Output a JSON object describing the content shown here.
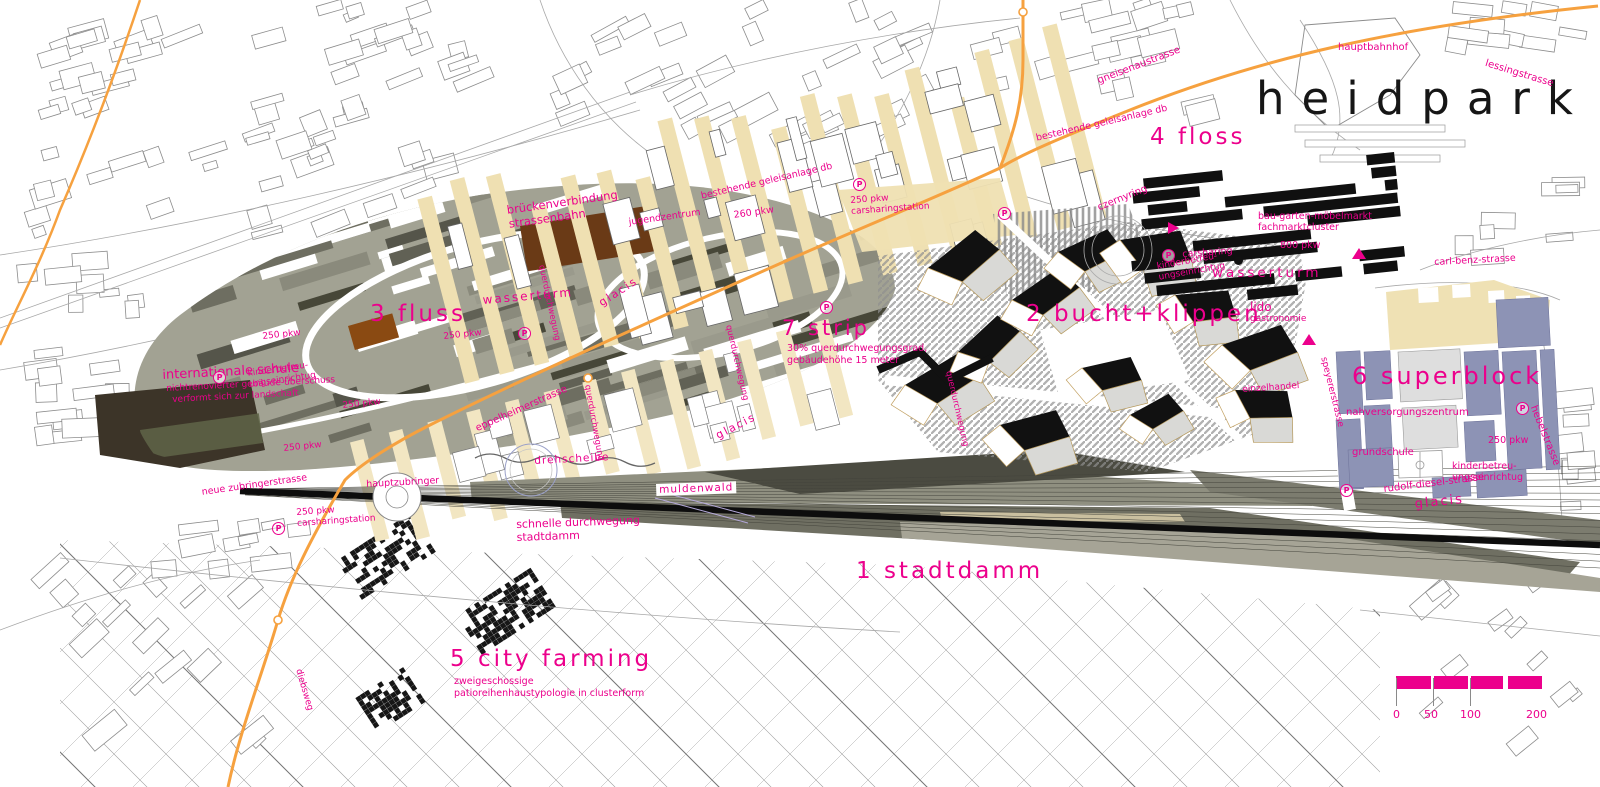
{
  "title": "heidpark",
  "zones": {
    "stadtdamm": {
      "label": "1 stadtdamm"
    },
    "bucht": {
      "label": "2 bucht+klippen"
    },
    "fluss": {
      "label": "3 fluss"
    },
    "floss": {
      "label": "4 floss"
    },
    "cityfarming": {
      "label": "5 city farming",
      "sub1": "zweigeschossige",
      "sub2": "patioreihenhaustypologie in clusterform"
    },
    "superblock": {
      "label": "6 superblock"
    },
    "strip": {
      "label": "7 strip",
      "sub1": "30% querdurchwegungsgrad,",
      "sub2": "gebäudehöhe 15 meter"
    }
  },
  "streets": {
    "gneisenaustrasse": "gneisenaustrasse",
    "lessingstrasse": "lessingstrasse",
    "carlbenz": "carl-benz-strasse",
    "czernyring": "czernyring",
    "eppelheimerstrasse": "eppelheimerstrasse",
    "speyererstrasse": "speyererstrasse",
    "hebelstrasse": "hebelstrasse",
    "rudolfdiesel": "rudolf-diesel-strasse",
    "neuezubringer": "neue zubringerstrasse",
    "hauptzubringer": "hauptzubringer",
    "diebsweg": "diebsweg"
  },
  "places": {
    "hauptbahnhof": "hauptbahnhof",
    "wasserturm": "wasserturm",
    "lido": "lido",
    "gastronomie": "gastronomie",
    "einzelhandel": "einzelhandel",
    "nahversorgung": "nahversorgungszentrum",
    "grundschule": "grundschule",
    "jugendzentrum": "jugendzentrum",
    "intschule": "internationale schule",
    "intschule_sub1": "nichtrenovierter gebäude-überschuss",
    "intschule_sub2": "verformt sich zur landschaft",
    "kinderbetreuung1": "kinderbetreu-",
    "kinderbetreuung2": "ungseinrichtug",
    "baugarten1": "bau-garten-möbelmarkt",
    "baugarten2": "fachmarktcluster",
    "drehscheibe": "drehscheibe",
    "muldenwald": "muldenwald",
    "glacis": "glacis",
    "querdurchwegung": "querdurchwegung",
    "carsharing": "carsharing",
    "carsharingstation": "carsharingstation"
  },
  "notes": {
    "bruecken1": "brückenverbindung",
    "bruecken2": "strassenbahn",
    "geleisanlage": "bestehende geleisanlage db",
    "schnelle1": "schnelle durchwegung",
    "schnelle2": "stadtdamm"
  },
  "parking": {
    "pkw250": "250 pkw",
    "pkw260": "260 pkw",
    "pkw800": "800 pkw",
    "p": "P"
  },
  "scalebar": {
    "t0": "0",
    "t1": "50",
    "t2": "100",
    "t3": "200"
  },
  "colors": {
    "accent": "#ec008c",
    "road": "#f6a13f",
    "ink": "#161616"
  }
}
